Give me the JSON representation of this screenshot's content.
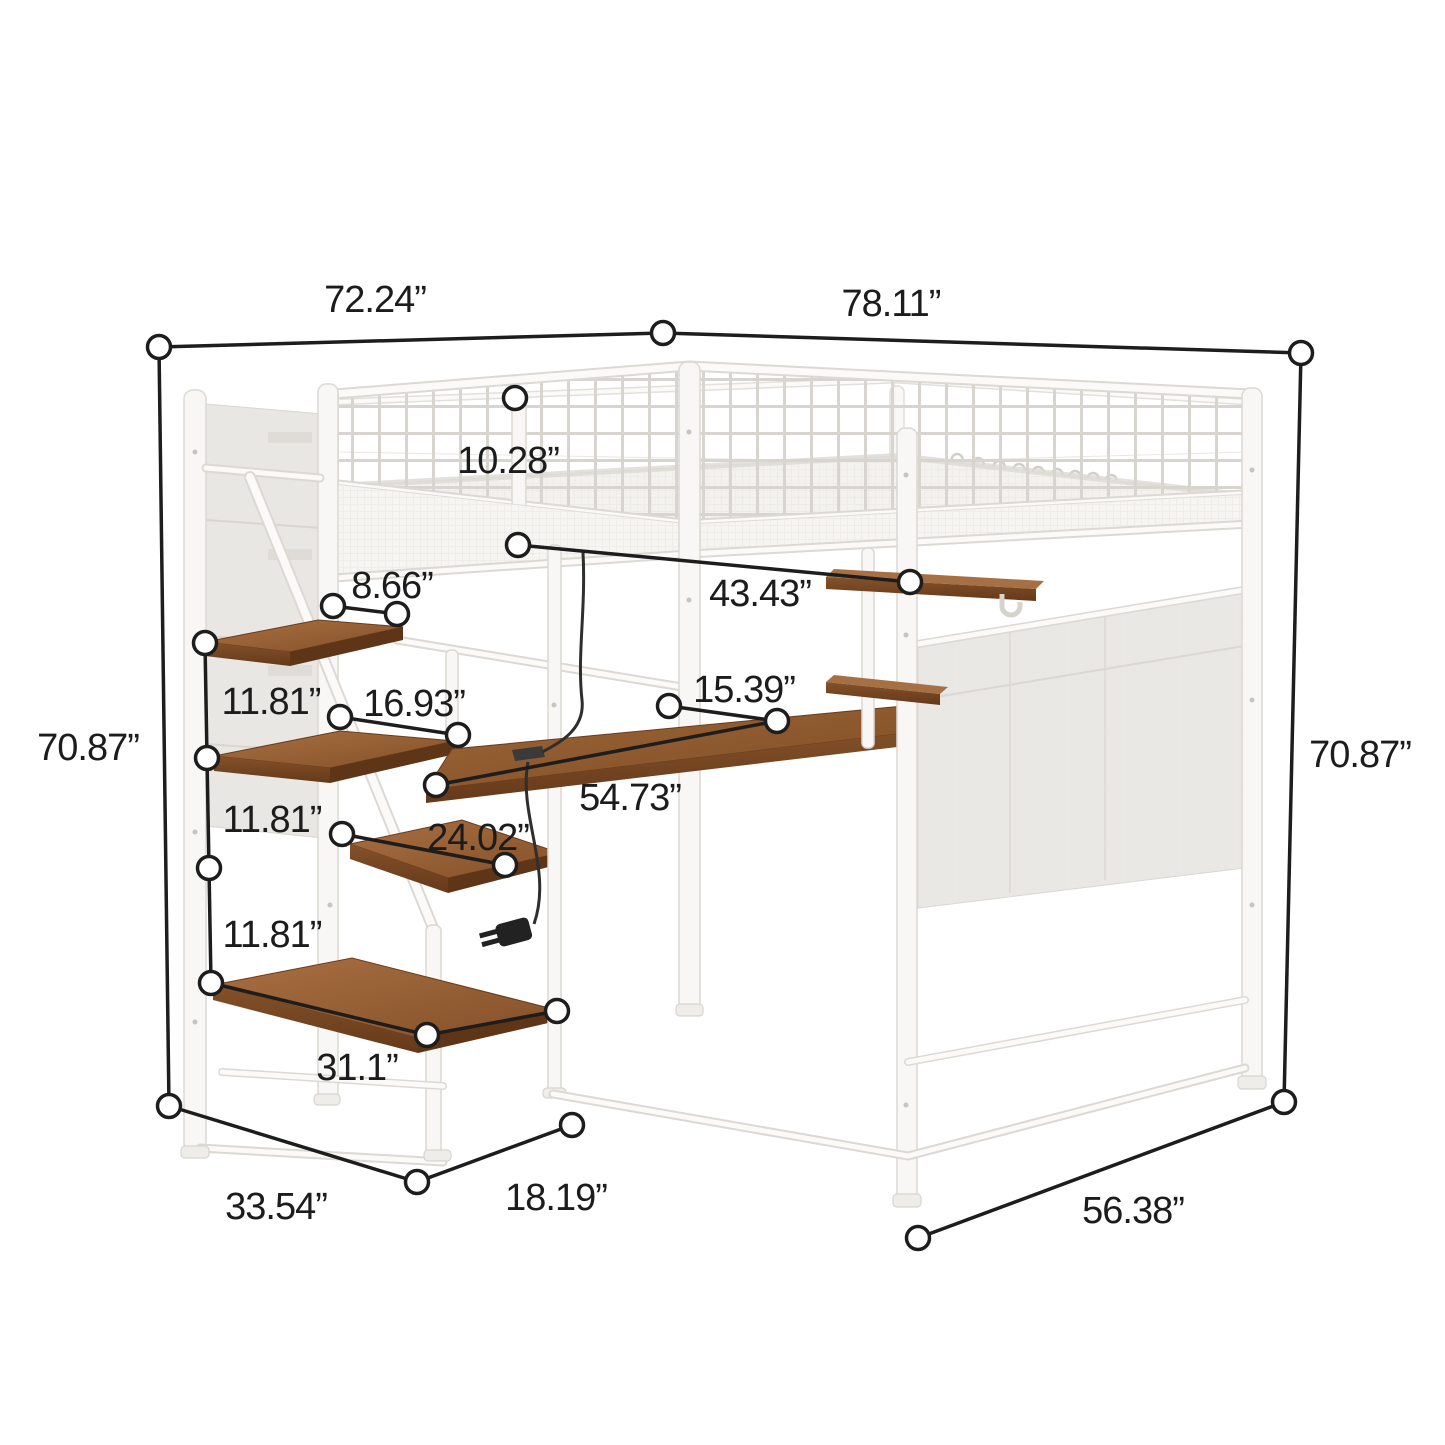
{
  "page": {
    "title": "Loft bed dimension diagram",
    "background": "#ffffff"
  },
  "diagram": {
    "subject": "metal loft bed with storage staircase, desk, hanging shelves and mesh panels",
    "unit": "inches",
    "style": {
      "dimension_line_color": "#1d1d1d",
      "label_color": "#1c1c1c",
      "frame_color": "#fafaf8",
      "frame_outline": "#dcd9d4",
      "wood_top_color": "#9a6134",
      "wood_front_color": "#6f3f1c",
      "fabric_panel_color": "#e9e7e3"
    },
    "labels": [
      {
        "id": "top-width-left",
        "text": "72.24”"
      },
      {
        "id": "top-width-right",
        "text": "78.11”"
      },
      {
        "id": "guardrail-height",
        "text": "10.28”"
      },
      {
        "id": "top-step-depth",
        "text": "8.66”"
      },
      {
        "id": "underbed-width",
        "text": "43.43”"
      },
      {
        "id": "shelf-spacing-1",
        "text": "11.81”"
      },
      {
        "id": "step-2-depth",
        "text": "16.93”"
      },
      {
        "id": "desk-depth",
        "text": "15.39”"
      },
      {
        "id": "overall-height-left",
        "text": "70.87”"
      },
      {
        "id": "overall-height-right",
        "text": "70.87”"
      },
      {
        "id": "desk-width",
        "text": "54.73”"
      },
      {
        "id": "shelf-spacing-2",
        "text": "11.81”"
      },
      {
        "id": "shelf-3-width",
        "text": "24.02”"
      },
      {
        "id": "shelf-spacing-3",
        "text": "11.81”"
      },
      {
        "id": "bottom-shelf-width",
        "text": "31.1”"
      },
      {
        "id": "stair-base-depth",
        "text": "33.54”"
      },
      {
        "id": "stair-base-side",
        "text": "18.19”"
      },
      {
        "id": "base-side-width",
        "text": "56.38”"
      }
    ]
  }
}
